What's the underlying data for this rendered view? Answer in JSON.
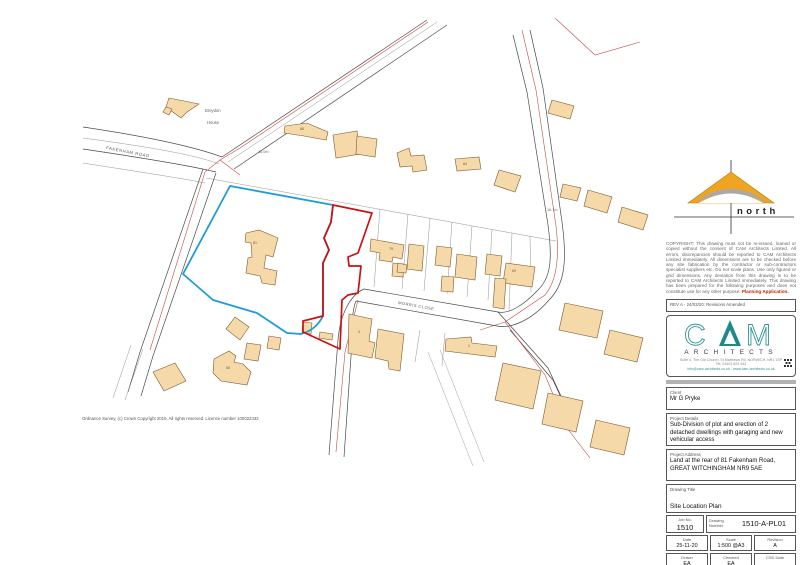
{
  "colors": {
    "building_fill": "#f6d9a8",
    "building_stroke": "#7d5a2e",
    "site_boundary_blue": "#1e9cd7",
    "application_boundary_red": "#cc1111",
    "thin_boundary_red": "#c24a4a",
    "road_line": "#4a4a4a",
    "north_arrow_orange": "#f0a522",
    "cam_teal": "#1d8a8a",
    "separator_grey": "#b3b3b3"
  },
  "map": {
    "labels": {
      "road_fakenham": "FAKENHAM ROAD",
      "road_morris": "MORRIS CLOSE",
      "house_name_line1": "Breydon",
      "house_name_line2": "House",
      "spot_height_a": "16.0m",
      "spot_height_b": "16.7m",
      "plot_86": "86",
      "plot_84": "84",
      "plot_81": "81",
      "plot_79": "79",
      "plot_69": "69",
      "plot_60": "60",
      "plot_1": "1",
      "plot_3": "3"
    },
    "os_attribution": "Ordnance Survey, (c) Crown Copyright 2015. All rights reserved. Licence number 100022432"
  },
  "panel": {
    "north_label": "north",
    "copyright_text": "COPYRIGHT: This drawing must not be re-issued, loaned or copied without the consent of CAM Architects Limited. All errors, discrepancies should be reported to CAM Architects Limited immediately. All dimensions are to be checked before any site fabrication by the contractor or sub-contractors specialist suppliers etc. Do not scale plans. Use only figured or grid dimensions. Any deviation from this drawing is to be reported to CAM Architects Limited immediately. This drawing has been prepared for the following purposes and does not constitute use for any other purpose: ",
    "copyright_purpose": "Planning Application.",
    "revision_note": "REV A - 24/03/20: Revisions Amended",
    "logo": {
      "letter_c": "C",
      "letter_m": "M",
      "architects": "ARCHITECTS",
      "address_line1": "Suite 4, The Old Church, St Matthews Rd, NORWICH, NR1 1SP",
      "address_line2": "Tel: 01603 623 443",
      "address_line3": "info@cam-architects.co.uk  -  www.cam-architects.co.uk"
    },
    "client_label": "Client",
    "client": "Mr G Pryke",
    "project_details_label": "Project Details",
    "project_details": "Sub-Division of plot and erection of 2 detached dwellings with garaging and new vehicular access",
    "project_address_label": "Project Address",
    "project_address": "Land at the rear of 81 Fakenham Road, GREAT WITCHINGHAM NR9 5AE",
    "drawing_title_label": "Drawing Title",
    "drawing_title": "Site Location Plan",
    "job_no_label": "Job No.",
    "job_no": "1510",
    "drawing_number_label": "Drawing Number",
    "drawing_number": "1510-A-PL01",
    "date_label": "Date",
    "date": "25-11-20",
    "scale_label": "Scale",
    "scale": "1:500 @A3",
    "revision_label": "Revision",
    "revision": "A",
    "drawn_label": "Drawn",
    "drawn": "EA",
    "checked_label": "Checked",
    "checked": "EA",
    "csd_label": "CSD Date",
    "csd_value": ""
  }
}
